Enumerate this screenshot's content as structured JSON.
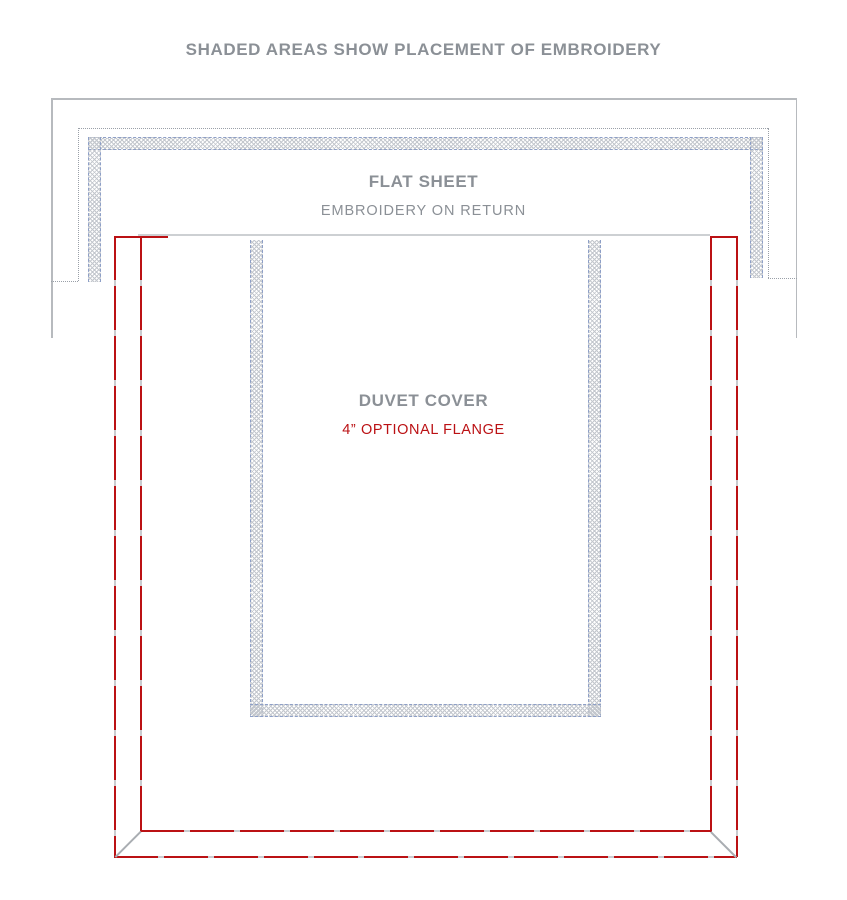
{
  "title": "SHADED AREAS SHOW PLACEMENT OF EMBROIDERY",
  "flat_sheet": {
    "label": "FLAT SHEET",
    "sublabel": "EMBROIDERY ON RETURN"
  },
  "duvet_cover": {
    "label": "DUVET COVER",
    "sublabel": "4” OPTIONAL FLANGE"
  },
  "legend": {
    "shaded_band_meaning": "embroidery placement area"
  },
  "colors": {
    "text_gray": "#8b9096",
    "accent_red": "#bb1114",
    "line_gray": "#b7babe",
    "dot_gray": "#9aa0a8",
    "dash_blue": "#8d9fc7",
    "hatch_gray": "#c3c7cd",
    "top_gray": "#cdd0d3",
    "diag_gray": "#a9adb2"
  }
}
